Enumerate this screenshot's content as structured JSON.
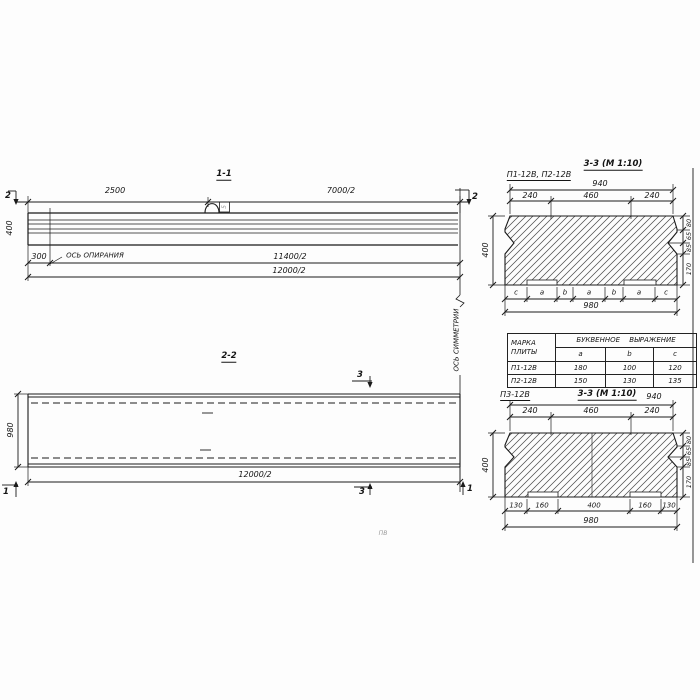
{
  "drawing": {
    "section_1_1": {
      "title": "1-1",
      "cut_label_left": "2",
      "cut_label_right": "2",
      "dim_top_left": "2500",
      "dim_top_right": "7000/2",
      "dim_height": "400",
      "dim_offset": "300",
      "bearing_axis_label": "ОСЬ ОПИРАНИЯ",
      "dim_bottom_inner": "11400/2",
      "dim_bottom_outer": "12000/2",
      "loop_flag": "5"
    },
    "section_2_2": {
      "title": "2-2",
      "cut_label_3_top": "3",
      "cut_label_3_bottom": "3",
      "cut_label_1_left": "1",
      "cut_label_1_right": "1",
      "dim_height": "980",
      "dim_bottom": "12000/2"
    },
    "symmetry_axis_label": "ОСЬ СИММЕТРИИ",
    "section_3_3_upper": {
      "label": "П1-12В, П2-12В",
      "title": "3-3 (М 1:10)",
      "dim_top_total": "940",
      "dim_top_segments": [
        "240",
        "460",
        "240"
      ],
      "dim_height": "400",
      "dim_right_segments": [
        "80",
        "65",
        "85",
        "170"
      ],
      "letter_segments": [
        "c",
        "a",
        "b",
        "a",
        "b",
        "a",
        "c"
      ],
      "dim_bottom_total": "980"
    },
    "table": {
      "header_col1_line1": "МАРКА",
      "header_col1_line2": "ПЛИТЫ",
      "header_group": "БУКВЕННОЕ ВЫРАЖЕНИЕ",
      "columns": [
        "a",
        "b",
        "c"
      ],
      "rows": [
        {
          "mark": "П1-12В",
          "a": "180",
          "b": "100",
          "c": "120"
        },
        {
          "mark": "П2-12В",
          "a": "150",
          "b": "130",
          "c": "135"
        }
      ]
    },
    "section_3_3_lower": {
      "label": "П3-12В",
      "title": "3-3 (М 1:10)",
      "dim_top_total": "940",
      "dim_top_segments": [
        "240",
        "460",
        "240"
      ],
      "dim_height": "400",
      "dim_right_segments": [
        "80",
        "65",
        "85",
        "170"
      ],
      "dim_bottom_segments": [
        "130",
        "160",
        "400",
        "160",
        "130"
      ],
      "dim_bottom_total": "980"
    },
    "stray_mark": "ПВ"
  }
}
